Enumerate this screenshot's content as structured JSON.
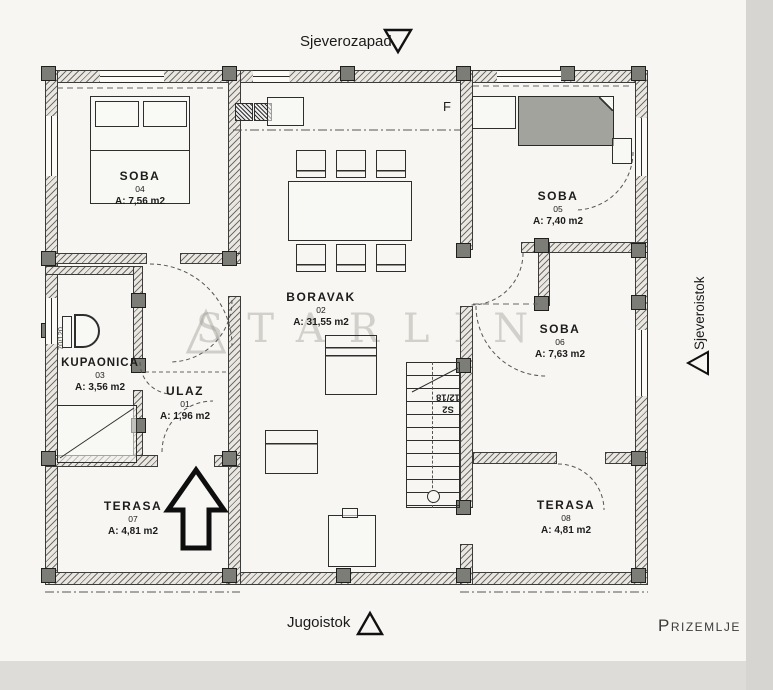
{
  "page": {
    "background": "#f7f6f2",
    "ink": "#1c1c1c",
    "scan_edge_color": "#d6d5d1",
    "watermark_color": "rgba(150,148,138,0.38)"
  },
  "orientation": {
    "top_label": "Sjeverozapad",
    "bottom_label": "Jugoistok",
    "right_label": "Sjeveroistok"
  },
  "floor_label": "Prizemlje",
  "watermark": "STARLIN",
  "grid_label": "F",
  "stairs_label": {
    "line1": "S2",
    "line2": "12/18"
  },
  "bath_dim": "70/120",
  "rooms": [
    {
      "key": "soba-04",
      "name": "SOBA",
      "number": "04",
      "area": "A: 7,56 m2"
    },
    {
      "key": "boravak",
      "name": "BORAVAK",
      "number": "02",
      "area": "A: 31,55 m2"
    },
    {
      "key": "kupaonica",
      "name": "KUPAONICA",
      "number": "03",
      "area": "A: 3,56 m2"
    },
    {
      "key": "soba-05",
      "name": "SOBA",
      "number": "05",
      "area": "A: 7,40 m2"
    },
    {
      "key": "soba-06",
      "name": "SOBA",
      "number": "06",
      "area": "A: 7,63 m2"
    },
    {
      "key": "ulaz",
      "name": "ULAZ",
      "number": "01",
      "area": "A: 1,96 m2"
    },
    {
      "key": "terasa-07",
      "name": "TERASA",
      "number": "07",
      "area": "A: 4,81 m2"
    },
    {
      "key": "terasa-08",
      "name": "TERASA",
      "number": "08",
      "area": "A: 4,81 m2"
    }
  ]
}
